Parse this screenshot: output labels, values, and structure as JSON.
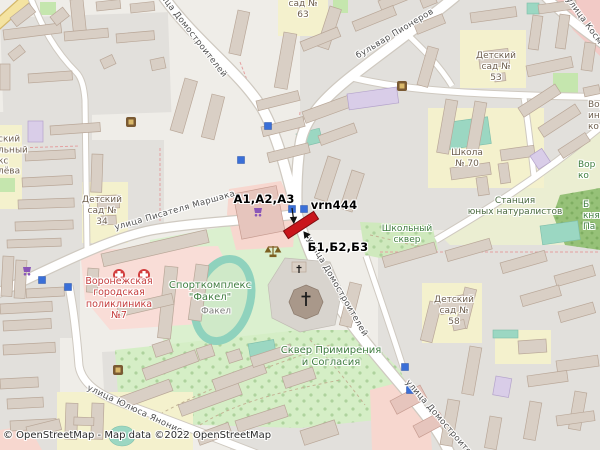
{
  "map": {
    "attribution": "© OpenStreetMap - Map data ©2022 OpenStreetMap",
    "annotations": {
      "group_a": "A1,A2,A3",
      "marker_id": "vrn444",
      "group_b": "Б1,Б2,Б3"
    },
    "streets": {
      "domostroiteley": "улица Домостроителей",
      "pionerov": "бульвар Пионеров",
      "marshaka": "улица Писателя Маршака",
      "yanonisa": "улица Юлюса Янониса",
      "kosmonavtov_fragment": "улица Косм"
    },
    "places": {
      "kindergarten_34": {
        "lines": [
          "Детский",
          "сад №",
          "34"
        ]
      },
      "kindergarten_63_fragment": {
        "lines": [
          "сад №",
          "63"
        ]
      },
      "kindergarten_53": {
        "lines": [
          "Детский",
          "сад №",
          "53"
        ]
      },
      "kindergarten_58": {
        "lines": [
          "Детский",
          "сад №",
          "58"
        ]
      },
      "school_70": {
        "lines": [
          "Школа",
          "№ 70"
        ]
      },
      "school_square": {
        "lines": [
          "Школьный",
          "сквер"
        ]
      },
      "reconciliation_square": {
        "lines": [
          "Сквер Примирения",
          "и Согласия"
        ]
      },
      "sport_complex": {
        "lines": [
          "Спорткомплекс",
          "\"Факел\""
        ],
        "sub": "Факел"
      },
      "polyclinic": {
        "lines": [
          "Воронежская",
          "городская",
          "поликлиника",
          "№7"
        ]
      },
      "naturalists_station": {
        "lines": [
          "Станция",
          "юных натуралистов"
        ]
      },
      "left_edge_fragments": {
        "lines": [
          "ский",
          "льный",
          "кс",
          "лёва"
        ]
      },
      "right_edge_fragment_a": {
        "lines": [
          "Вор",
          "ин",
          "ко"
        ]
      },
      "right_edge_fragment_b": {
        "lines": [
          "Вор",
          "ко"
        ]
      },
      "right_edge_fragment_c": {
        "lines": [
          "Б",
          "княз",
          "Па"
        ]
      }
    },
    "colors": {
      "marker_red": "#c9151b",
      "park_label_green": "#3f7d3f",
      "hospital_red": "#c43c3c",
      "bus_blue": "#3a6fd8"
    }
  }
}
